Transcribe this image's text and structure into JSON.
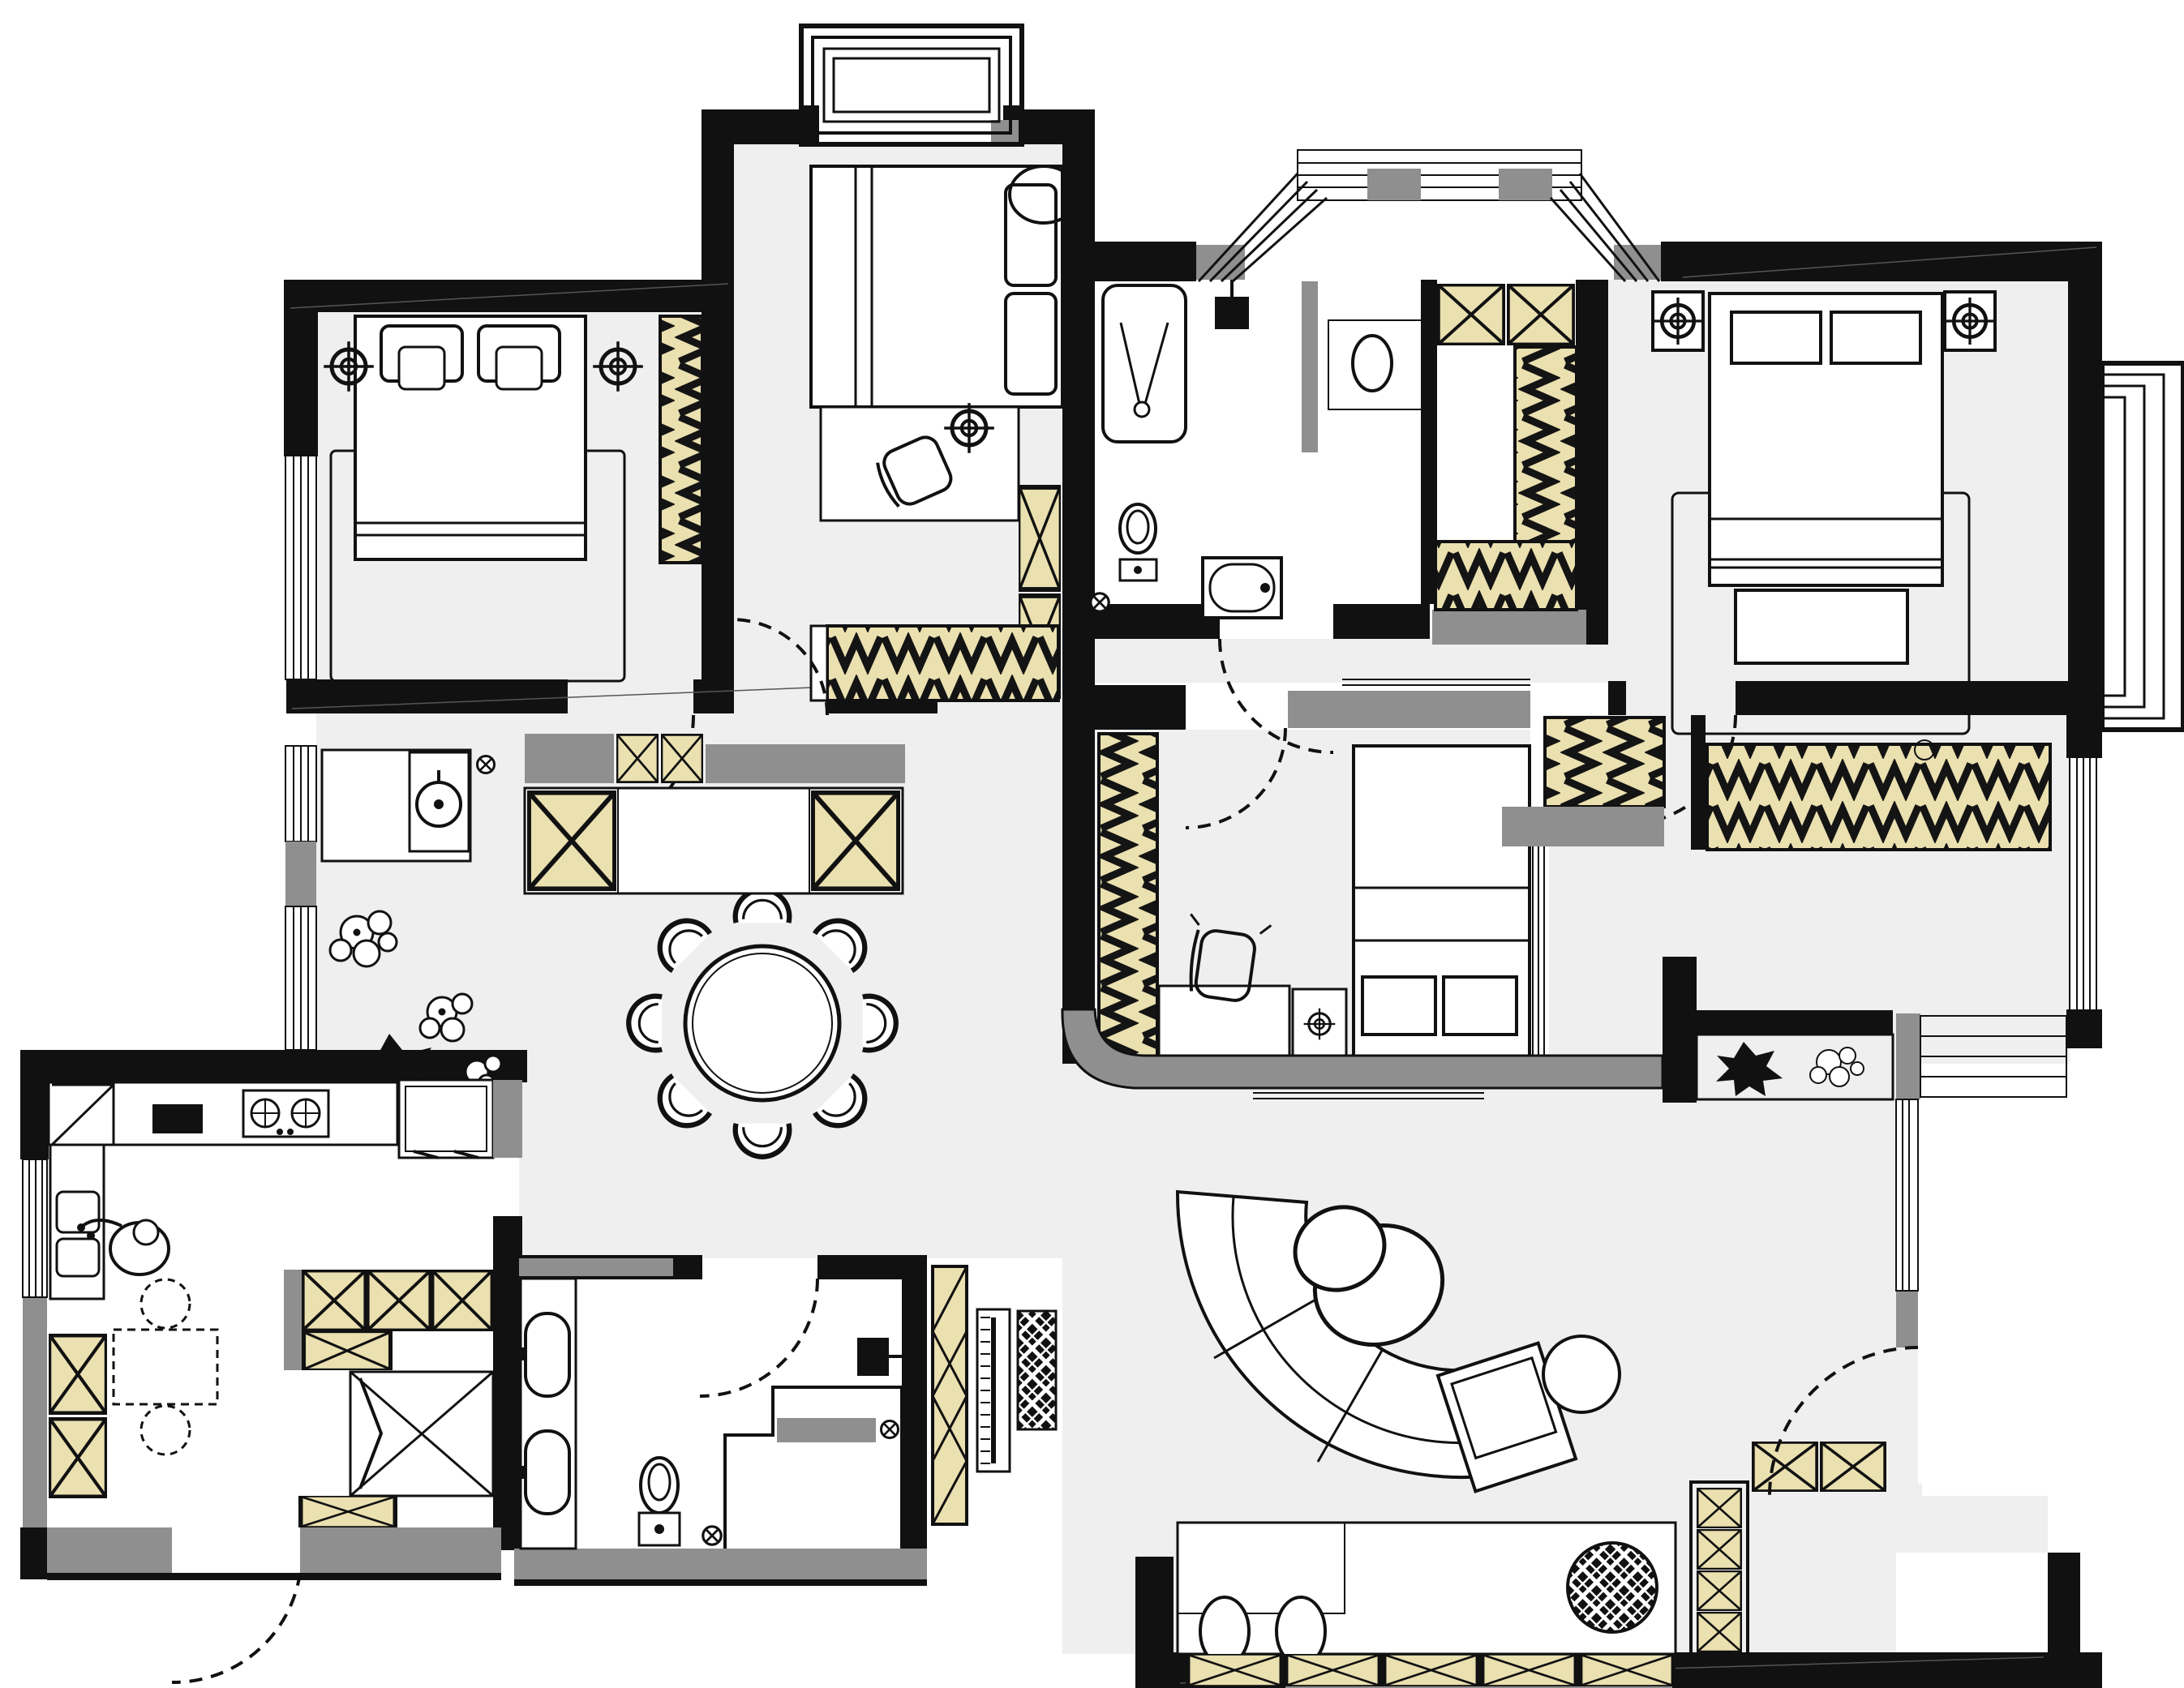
{
  "meta": {
    "title": "Apartment floor plan",
    "drawing_type": "architectural plan, top view, black line work with tinted joinery",
    "visible_text": "none"
  },
  "palette": {
    "wall_black": "#111111",
    "floor_gray": "#efefef",
    "secondary_wall_gray": "#8f8f8f",
    "joinery_yellow": "#eae0b0",
    "line_black": "#000000",
    "background_white": "#ffffff"
  },
  "legend": {
    "crossed_box": "storage cabinet / shoe cabinet (box with X)",
    "zigzag_strip": "wardrobe with hanging rail",
    "diamond_hatch": "rattan / woven basket texture",
    "target_symbol": "recessed ceiling downlight",
    "circle_with_x": "floor drain",
    "dashed_arc": "door swing",
    "parallel_lines": "window / glazing"
  },
  "rooms": {
    "bedroom_top_left": {
      "label": "Bedroom top-left",
      "furniture": [
        "double bed with two pillows",
        "area rug",
        "hanging wardrobe",
        "two ceiling downlights",
        "left wall window"
      ]
    },
    "bedroom_top_middle": {
      "label": "Bedroom top-middle",
      "furniture": [
        "double bed with two stacked pillows",
        "desk with chair",
        "round ottoman",
        "tall crossed-box cabinet",
        "hanging wardrobe",
        "ceiling downlight",
        "north balcony bay window"
      ]
    },
    "bathroom_top": {
      "label": "Bathroom top",
      "furniture": [
        "shower cabin with V shower tree",
        "wall shower head",
        "toilet",
        "bathtub",
        "round washbasin",
        "glass partition",
        "floor drain",
        "trapezoid bay window"
      ]
    },
    "walk_in_closet": {
      "label": "Walk-in closet",
      "furniture": [
        "two crossed storage boxes",
        "vertical hanging rail",
        "horizontal hanging rail"
      ]
    },
    "master_bedroom": {
      "label": "Master bedroom",
      "furniture": [
        "double bed with two pillows",
        "area rug",
        "foot bench",
        "two framed downlights",
        "east bay window"
      ]
    },
    "bedroom_right": {
      "label": "Bedroom middle-right",
      "furniture": [
        "bed with two pillows",
        "hanging wardrobe",
        "desk",
        "swivel chair",
        "nightstand with downlight",
        "glazed strip",
        "curved bulkhead"
      ]
    },
    "dining_area": {
      "label": "Dining area",
      "furniture": [
        "round dining table",
        "eight chairs",
        "potted plants"
      ]
    },
    "kitchen": {
      "label": "Kitchen",
      "furniture": [
        "L-shaped counter",
        "two-burner stove",
        "black cutting board",
        "refrigerator",
        "sink unit",
        "person figure at sink",
        "small table with two stools",
        "crossed storage boxes",
        "drying closet",
        "balcony door"
      ]
    },
    "laundry_hall": {
      "label": "Laundry hallway",
      "furniture": [
        "washing machine",
        "counter",
        "upper and base cabinets",
        "floor drain"
      ]
    },
    "bathroom_bottom": {
      "label": "Bathroom bottom",
      "furniture": [
        "double vanity with two basins",
        "toilet",
        "walk-in shower with bench",
        "water heater",
        "two floor drains",
        "swing door"
      ]
    },
    "living_room": {
      "label": "Living room",
      "furniture": [
        "curved sectional sofa",
        "egg lounge chair with cushion",
        "round side table",
        "TV panel",
        "diamond-hatch rug",
        "media console with two oval stools",
        "rattan pouf",
        "crossed shoe cabinets",
        "planter box with plants",
        "entry door"
      ]
    },
    "entry": {
      "label": "Entry",
      "furniture": [
        "right-wall entry door with swing",
        "shoe cabinets",
        "window strip"
      ]
    }
  },
  "counts": {
    "ceiling_downlights": 6,
    "floor_drains": 4,
    "door_swings": 9,
    "dining_chairs": 8,
    "bay_windows": 3
  }
}
